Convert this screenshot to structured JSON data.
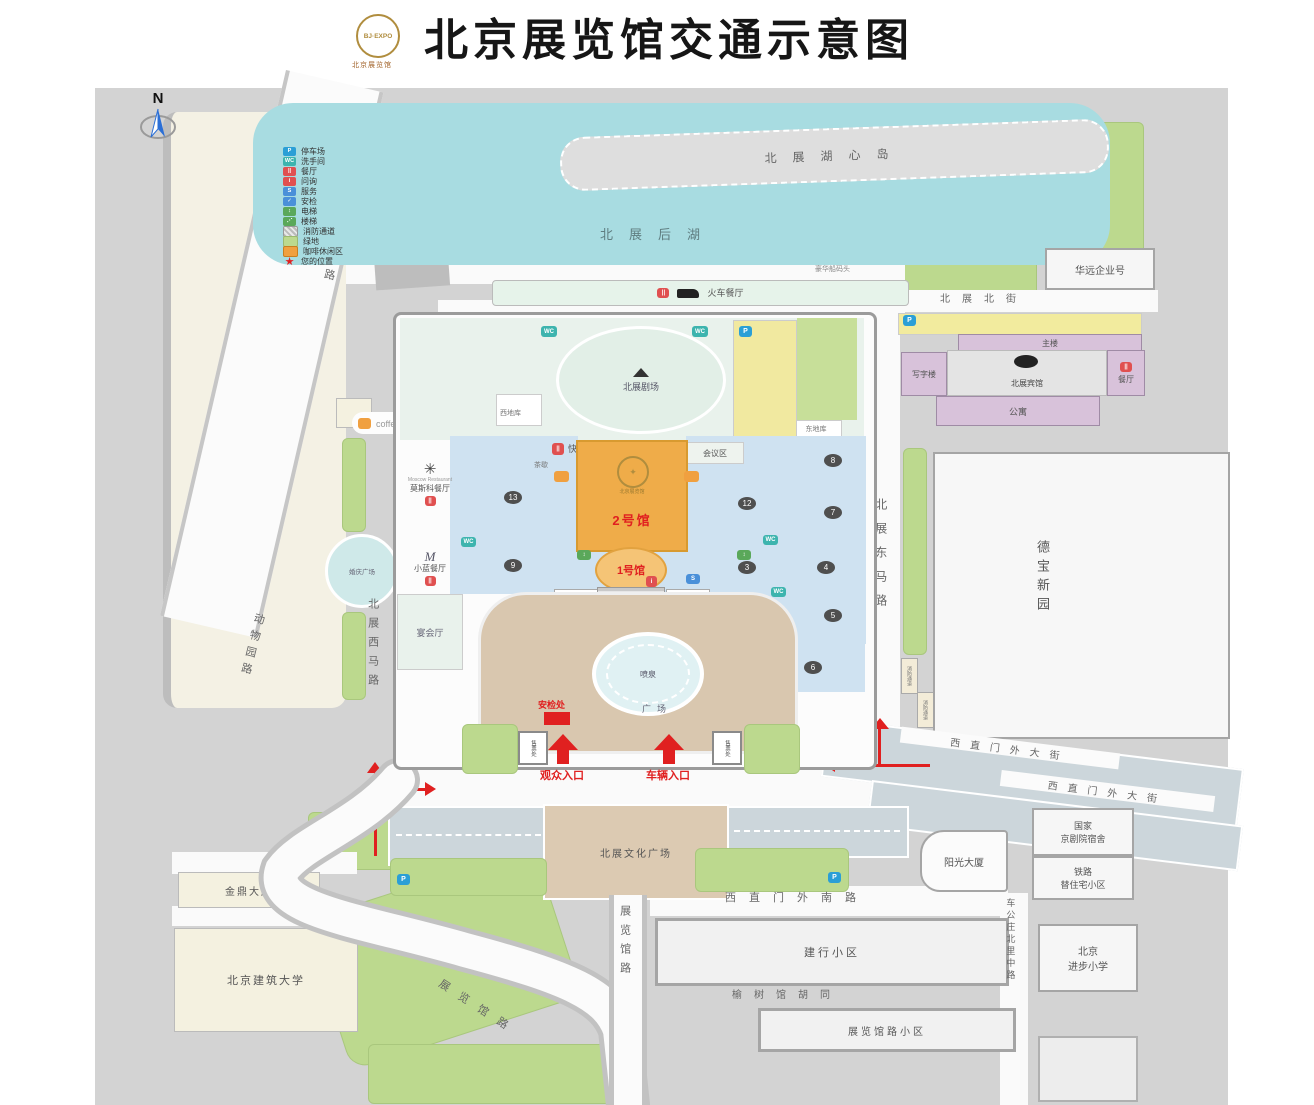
{
  "title": "北京展览馆交通示意图",
  "logo": {
    "line1": "BJ·EXPO",
    "caption": "北京展览馆"
  },
  "compass_label": "N",
  "legend": {
    "items": [
      {
        "label": "停车场",
        "glyph": "P",
        "color": "#2b9fd6"
      },
      {
        "label": "洗手间",
        "glyph": "WC",
        "color": "#3db4ae"
      },
      {
        "label": "餐厅",
        "glyph": "||",
        "color": "#e05050"
      },
      {
        "label": "问询",
        "glyph": "i",
        "color": "#e05050"
      },
      {
        "label": "服务",
        "glyph": "S",
        "color": "#4a90d9"
      },
      {
        "label": "安检",
        "glyph": "✓",
        "color": "#4a90d9"
      },
      {
        "label": "电梯",
        "glyph": "↕",
        "color": "#5aa85a"
      },
      {
        "label": "楼梯",
        "glyph": "⋰",
        "color": "#5aa85a"
      },
      {
        "label": "消防通道",
        "glyph": "",
        "color": "#c9c9c9"
      },
      {
        "label": "绿地",
        "glyph": "",
        "color": "#bcd98e"
      },
      {
        "label": "咖啡休闲区",
        "glyph": "",
        "color": "#f0a040"
      },
      {
        "label": "您的位置",
        "glyph": "★",
        "color": "transparent"
      }
    ]
  },
  "water": {
    "island": "北展湖心岛",
    "lake": "北展后湖",
    "wharf": "豪华船码头"
  },
  "north": {
    "train_restaurant": "火车餐厅",
    "huayuan": "华远企业号",
    "beizhan_north_street": "北展北街",
    "main_building": "主楼",
    "office_building": "写字楼",
    "hotel": "北展宾馆",
    "hotel_restaurant": "餐厅",
    "apartment": "公寓"
  },
  "west": {
    "zoo": "北京动物园",
    "zoo_road_upper": "动物园路",
    "zoo_road_lower": "动物园路",
    "beizhan_west_road": "北展西马路",
    "wedding_plaza": "婚庆广场",
    "coffee_bar": "coffee·遇"
  },
  "east": {
    "beizhan_east_road": "北展东马路",
    "debao_xinyuan": "德宝新园",
    "fire_lane_a": "消防通道",
    "fire_lane_b": "消防通道",
    "xizhimen_outer_street_a": "西直门外大街",
    "xizhimen_outer_street_b": "西直门外大街"
  },
  "complex": {
    "theater": "北展剧场",
    "west_garage": "西地库",
    "east_garage": "东地库",
    "fast_food": "快餐厅",
    "tea_break": "茶歇",
    "conference_area": "会议区",
    "hall_2": "2号馆",
    "hall_1": "1号馆",
    "main_entrance": "主入口",
    "vip_room_left": "贵宾室",
    "vip_room_right": "贵宾室",
    "banquet_hall": "宴会厅",
    "moscow_restaurant": "莫斯科餐厅",
    "moscow_restaurant_en": "Moscow Restaurant",
    "xiaolan_restaurant": "小蓝餐厅",
    "fountain": "喷泉",
    "plaza": "广场",
    "security_check": "安检处",
    "ticket_office_left": "售票处",
    "ticket_office_right": "售票处",
    "visitor_entrance": "观众入口",
    "vehicle_entrance": "车辆入口",
    "hall_numbers": [
      "13",
      "9",
      "12",
      "8",
      "7",
      "3",
      "4",
      "5",
      "6"
    ]
  },
  "south": {
    "culture_plaza": "北展文化广场",
    "xizhimen_south_road": "西直门外南路",
    "jianhang_community": "建行小区",
    "yushuguan_hutong": "榆树馆胡同",
    "zhanlanguan_community": "展览馆路小区",
    "zhanlanguan_road_diag": "展览馆路",
    "zhanlanguan_road_vert": "展览馆路",
    "chegongzhuang_road": "车公庄北里中路",
    "sunshine_tower": "阳光大厦",
    "opera_dorm_line1": "国家",
    "opera_dorm_line2": "京剧院宿舍",
    "railway_line1": "铁路",
    "railway_line2": "替住宅小区",
    "school_line1": "北京",
    "school_line2": "进步小学",
    "jinding_tower": "金鼎大厦",
    "jianzhu_university": "北京建筑大学"
  },
  "colors": {
    "map_gray": "#d3d3d3",
    "water": "#a8dce1",
    "green": "#bcd98e",
    "hall_orange": "#efac49",
    "hall1_orange": "#f5c476",
    "plaza_tan": "#d9c7af",
    "road_blue_gray": "#ccd6db",
    "yellow_parking": "#f2eb9e",
    "purple_building": "#d8c2da",
    "accent_red": "#e02020"
  }
}
